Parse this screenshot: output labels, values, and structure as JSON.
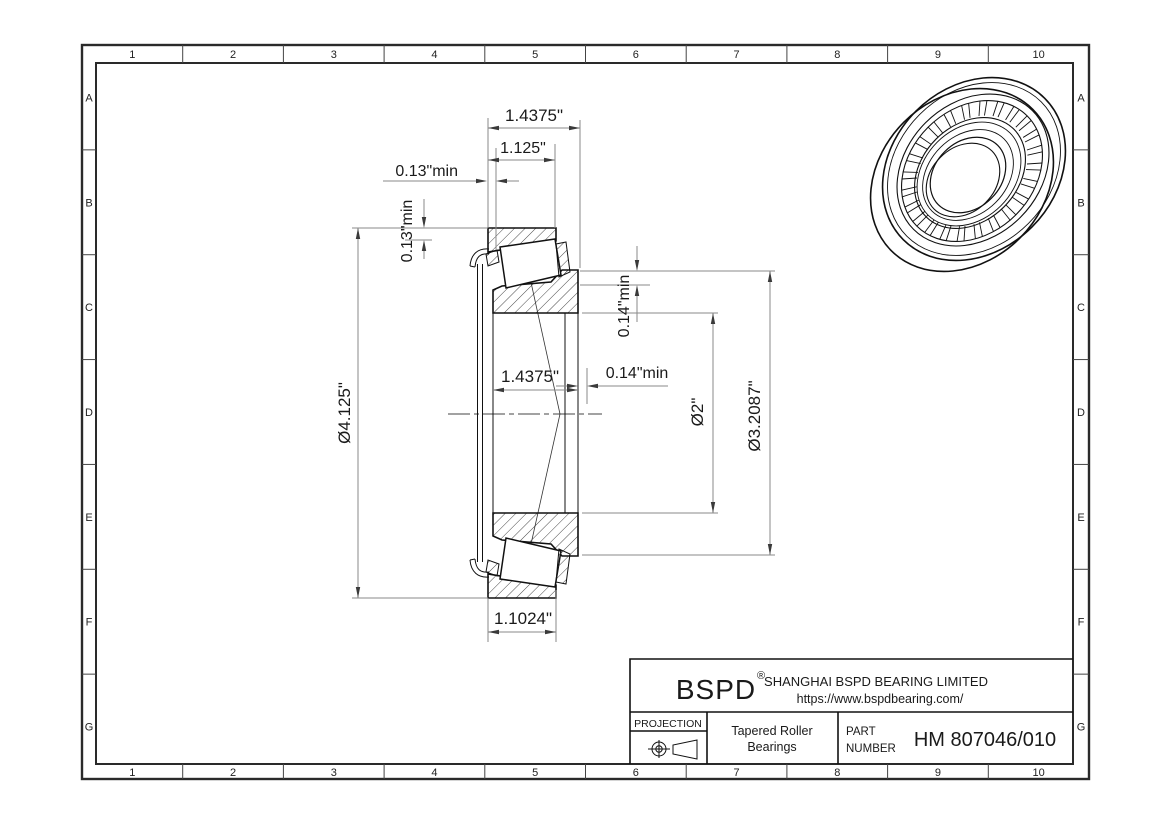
{
  "grid": {
    "columns": [
      "1",
      "2",
      "3",
      "4",
      "5",
      "6",
      "7",
      "8",
      "9",
      "10"
    ],
    "rows": [
      "A",
      "B",
      "C",
      "D",
      "E",
      "F",
      "G"
    ]
  },
  "dimensions": {
    "overall_width": "1.4375\"",
    "cup_standout": "1.125\"",
    "clearance_back_h": "0.13\"min",
    "clearance_back_v": "0.13\"min",
    "outer_diameter": "Ø4.125\"",
    "cone_width": "1.4375\"",
    "clearance_front_h": "0.14\"min",
    "clearance_front_v": "0.14\"min",
    "bore_diameter": "Ø2\"",
    "shoulder_diameter": "Ø3.2087\"",
    "cup_width": "1.1024\""
  },
  "title_block": {
    "logo": "BSPD",
    "registered_mark": "®",
    "company": "SHANGHAI BSPD BEARING LIMITED",
    "website": "https://www.bspdbearing.com/",
    "projection_label": "PROJECTION",
    "product_line1": "Tapered Roller",
    "product_line2": "Bearings",
    "part_label_line1": "PART",
    "part_label_line2": "NUMBER",
    "part_number": "HM 807046/010"
  },
  "colors": {
    "line": "#111111",
    "dim_line": "#8a8a8a",
    "background": "#ffffff"
  }
}
